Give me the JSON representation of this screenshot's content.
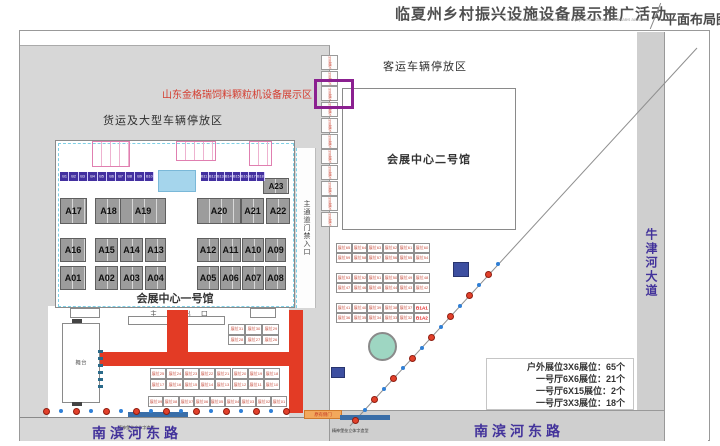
{
  "header": {
    "title_cn": "临夏州乡村振兴设施设备展示推广活动",
    "title_en": "Linxia rural revitalization technical equipment exhibition and sales activities",
    "map_label": "平面布局图"
  },
  "callout": {
    "text": "山东金格瑞饲料颗粒机设备展示区"
  },
  "zones": {
    "freight_parking": "货运及大型车辆停放区",
    "passenger_parking": "客运车辆停放区",
    "hall1_label": "会展中心一号馆",
    "hall2_label": "会展中心二号馆",
    "main_gate": "主 入 出 口",
    "corridor_gate": "主通道门禁入口",
    "stage": "舞台",
    "old_side_gate": "原有侧门",
    "spirit_sign_left": "精神堡垒立体字造型",
    "spirit_sign_right": "精神堡垒立体字造型"
  },
  "roads": {
    "south_left": "南滨河东路",
    "south_right": "南滨河东路",
    "east": "牛津河大道"
  },
  "hall1_booths": {
    "b_left": [
      "B1",
      "B2",
      "B3",
      "B4",
      "B5",
      "B6",
      "B7",
      "B8",
      "B9",
      "B10"
    ],
    "b_right": [
      "B11",
      "B12",
      "B13",
      "B14",
      "B15",
      "B16",
      "B17",
      "B18"
    ],
    "a23": "A23",
    "row1": [
      "A17",
      "A18",
      "A19",
      "A20",
      "A21",
      "A22"
    ],
    "row2": [
      "A16",
      "A15",
      "A14",
      "A13",
      "A12",
      "A11",
      "A10",
      "A09"
    ],
    "row3": [
      "A01",
      "A02",
      "A03",
      "A04",
      "A05",
      "A06",
      "A07",
      "A08"
    ]
  },
  "outdoor_strip": {
    "cells": [
      "3X6展位",
      "3X6展位",
      "3X6展位",
      "3X6展位",
      "3X6展位",
      "3X6展位",
      "3X6展位",
      "3X6展位",
      "3X6展位",
      "3X6展位",
      "3X6展位"
    ],
    "highlight_index": 1
  },
  "plaza_grids": {
    "top": [
      [
        "展位31",
        "展位30",
        "展位29"
      ],
      [
        "展位28",
        "展位27",
        "展位26"
      ]
    ],
    "mid": [
      [
        "展位25",
        "展位24",
        "展位23",
        "展位22",
        "展位21",
        "展位20",
        "展位19",
        "展位18"
      ],
      [
        "展位17",
        "展位16",
        "展位15",
        "展位14",
        "展位13",
        "展位12",
        "展位11",
        "展位10"
      ]
    ],
    "bottom": [
      [
        "展位09",
        "展位08",
        "展位07",
        "展位06",
        "展位05",
        "展位04",
        "展位03",
        "展位02",
        "展位01"
      ]
    ]
  },
  "right_grids": [
    [
      [
        "展位65",
        "展位64",
        "展位63",
        "展位62",
        "展位61",
        "展位60"
      ],
      [
        "展位59",
        "展位58",
        "展位57",
        "展位56",
        "展位55",
        "展位54"
      ]
    ],
    [
      [
        "展位53",
        "展位52",
        "展位51",
        "展位50",
        "展位49",
        "展位48"
      ],
      [
        "展位47",
        "展位46",
        "展位45",
        "展位44",
        "展位43",
        "展位42"
      ]
    ],
    [
      [
        "展位41",
        "展位40",
        "展位39",
        "展位38",
        "展位37",
        "B1A1"
      ],
      [
        "展位36",
        "展位35",
        "展位34",
        "展位33",
        "展位32",
        "B1A2"
      ]
    ]
  ],
  "stats": {
    "lines": [
      "户外展位3X6展位：65个",
      "一号厅6X6展位：21个",
      "一号厅6X15展位：2个",
      "一号厅3X3展位：18个"
    ]
  },
  "colors": {
    "accent_purple": "#8b2090",
    "corridor_red": "#e33b25",
    "road_text_purple": "#43339b",
    "callout_red": "#d43c2f",
    "booth_gray": "#9c9c9c",
    "b_booth_purple": "#4330a0",
    "dot_red": "#e2402a",
    "dot_blue": "#2f7fd6"
  }
}
